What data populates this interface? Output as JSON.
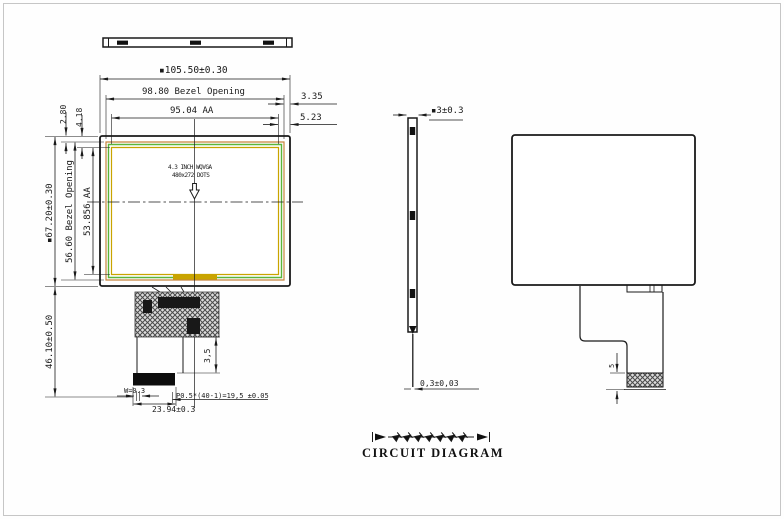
{
  "front_view": {
    "dim_total_width": "▪105.50±0.30",
    "dim_bezel_width": "98.80 Bezel Opening",
    "dim_aa_width": "95.04 AA",
    "dim_offset_bezel_right": "3.35",
    "dim_offset_aa_right": "5.23",
    "dim_offset_bezel_top": "2.80",
    "dim_offset_aa_top": "4.18",
    "dim_total_height": "▪67.20±0.30",
    "dim_bezel_height": "56.60 Bezel Opening",
    "dim_aa_height": "53.856 AA",
    "dim_module_to_connector_end": "46.10±0.50",
    "panel_label_line1": "4.3 INCH WQVGA",
    "panel_label_line2": "480x272 DOTS",
    "dim_fpc_tail_length": "3,5",
    "dim_trace_width": "W=0.3",
    "dim_pin_pitch": "P0.5*(40-1)=19,5 ±0.05",
    "dim_connector_width": "23.94±0.3"
  },
  "side_view": {
    "dim_thickness": "▪3±0.3",
    "dim_fpc_thickness": "0,3±0,03"
  },
  "back_view": {
    "dim_stiffener_height": "5"
  },
  "circuit": {
    "title": "CIRCUIT DIAGRAM",
    "led_count": 7
  },
  "colors": {
    "line": "#1a1a1a",
    "bezel_outline": "#c8853c",
    "panel_outline": "#5bb53a",
    "aa_outline": "#c9a400",
    "contact_bar": "#c9a400"
  }
}
